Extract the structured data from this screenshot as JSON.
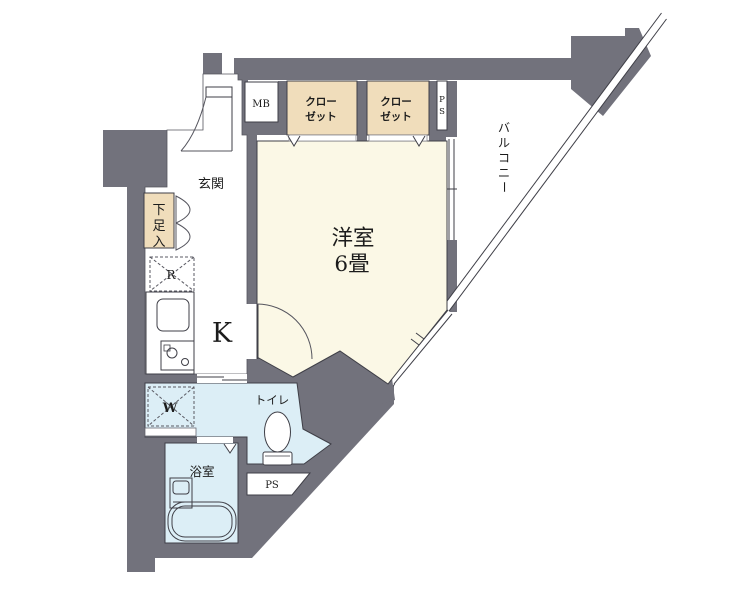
{
  "plan": {
    "labels": {
      "main_room_line1": "洋室",
      "main_room_line2": "6畳",
      "kitchen": "K",
      "entrance": "玄関",
      "toilet": "トイレ",
      "bathroom": "浴室",
      "balcony_chars": [
        "バ",
        "ル",
        "コ",
        "ニ",
        "ー"
      ],
      "shoe_cabinet_chars": [
        "下",
        "足",
        "入"
      ],
      "closets": [
        {
          "line1": "クロー",
          "line2": "ゼット"
        },
        {
          "line1": "クロー",
          "line2": "ゼット"
        }
      ],
      "meter_box": "MB",
      "pipe_space_top_chars": [
        "P",
        "S"
      ],
      "pipe_space_bottom": "PS",
      "washer": "W",
      "refrigerator": "R"
    },
    "colors": {
      "wall": "#72727c",
      "room": "#fbf8e6",
      "closet": "#f0ddbb",
      "wet_area": "#dceef6",
      "line": "#3f3f47",
      "white": "#ffffff"
    }
  }
}
